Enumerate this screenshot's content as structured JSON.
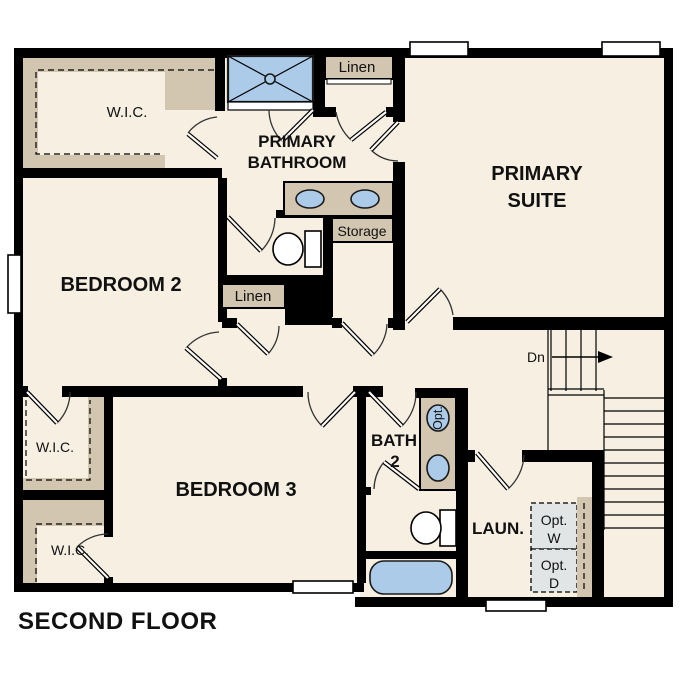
{
  "floor_title": "SECOND FLOOR",
  "rooms": {
    "primary_suite": {
      "line1": "PRIMARY",
      "line2": "SUITE"
    },
    "primary_bathroom": {
      "line1": "PRIMARY",
      "line2": "BATHROOM"
    },
    "bedroom_2": {
      "label": "BEDROOM 2"
    },
    "bedroom_3": {
      "label": "BEDROOM 3"
    },
    "bath_2": {
      "line1": "BATH",
      "line2": "2"
    },
    "laundry": {
      "label": "LAUN."
    }
  },
  "closets": {
    "wic_primary": {
      "label": "W.I.C."
    },
    "wic_left": {
      "label": "W.I.C."
    },
    "wic_lower": {
      "label": "W.I.C."
    },
    "linen_upper": {
      "label": "Linen"
    },
    "linen_hall": {
      "label": "Linen"
    },
    "storage": {
      "label": "Storage"
    }
  },
  "fixtures": {
    "optional_sink": {
      "label": "Opt."
    },
    "optional_washer": {
      "line1": "Opt.",
      "line2": "W"
    },
    "optional_dryer": {
      "line1": "Opt.",
      "line2": "D"
    }
  },
  "stairs": {
    "down_label": "Dn"
  },
  "colors": {
    "background": "#ffffff",
    "floor": "#f6efe2",
    "wall": "#000000",
    "casework_tan": "#d2c6b0",
    "fixture_blue": "#abcbe9",
    "optional_appliance_gray": "#e2e5e6",
    "text": "#111111"
  }
}
